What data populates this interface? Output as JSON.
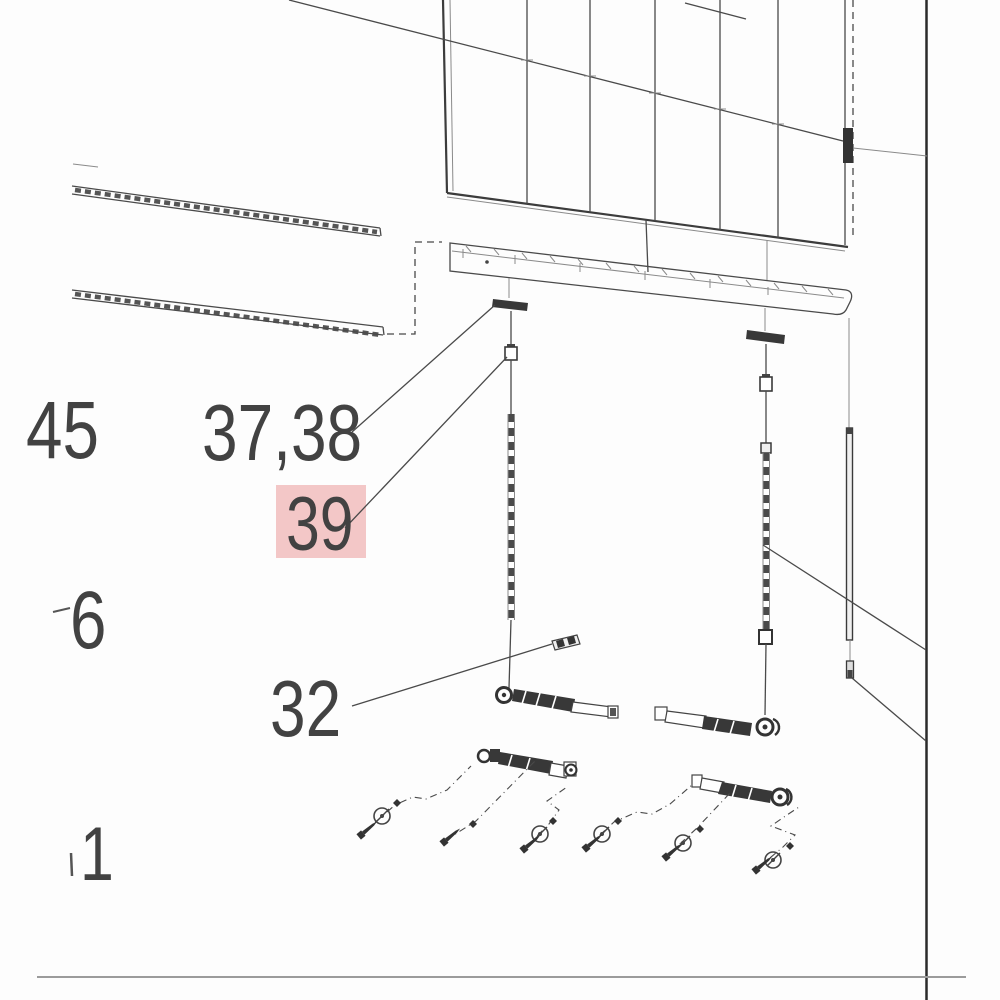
{
  "figure": {
    "description_text": "",
    "background": "#fdfdfd",
    "line_color": "#4a4a4a",
    "highlight_color": "#f3c7c7",
    "border_right_color": "#2b2b2b",
    "border_bottom_color": "#9b9b9b",
    "callouts": [
      {
        "id": "45",
        "label": "45",
        "highlighted": false
      },
      {
        "id": "37_38",
        "label": "37,38",
        "highlighted": false
      },
      {
        "id": "39",
        "label": "39",
        "highlighted": true
      },
      {
        "id": "6",
        "label": "6",
        "highlighted": false
      },
      {
        "id": "32",
        "label": "32",
        "highlighted": false
      },
      {
        "id": "1",
        "label": "1",
        "highlighted": false
      }
    ]
  }
}
